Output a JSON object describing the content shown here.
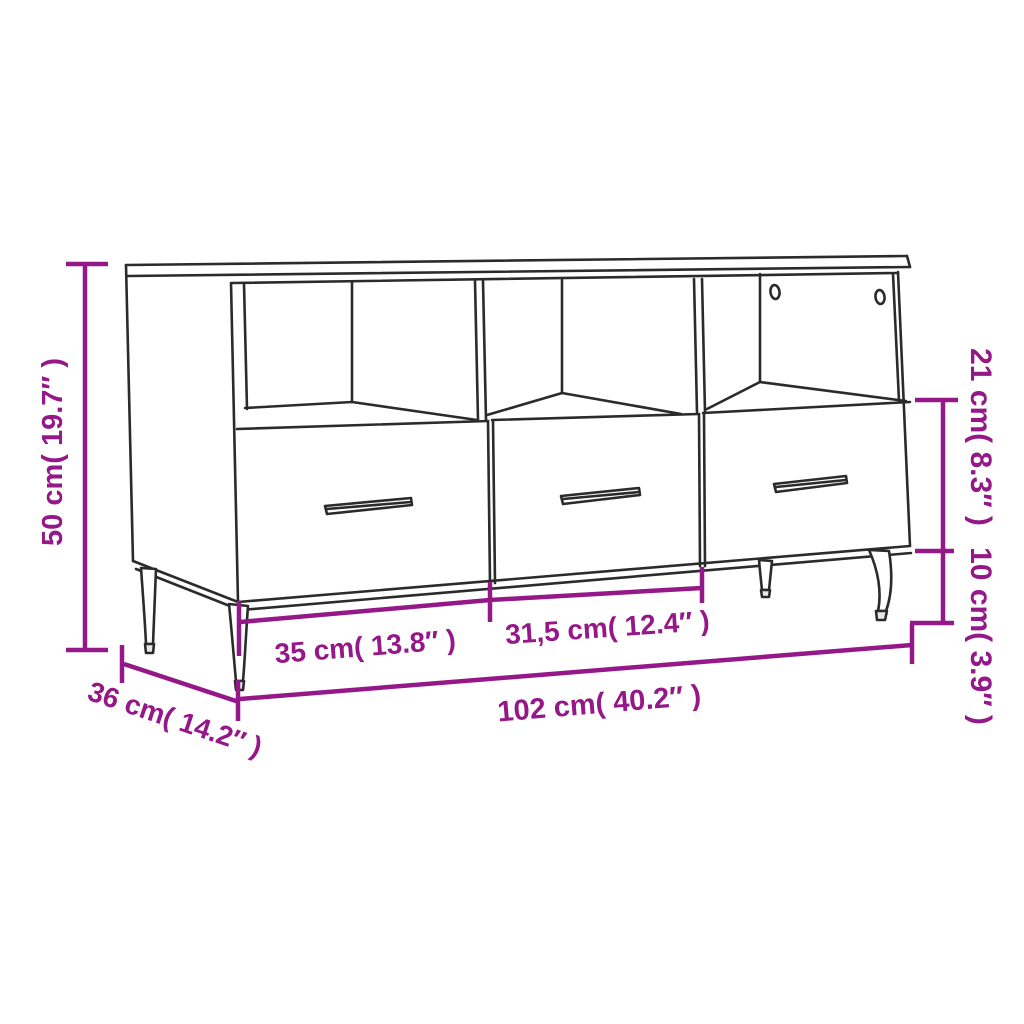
{
  "dimensions": {
    "height": "50 cm( 19.7″ )",
    "depth": "36 cm( 14.2″ )",
    "width": "102 cm( 40.2″ )",
    "left_drawer_width": "35 cm( 13.8″ )",
    "middle_drawer_width": "31,5 cm( 12.4″ )",
    "top_section_height": "21 cm( 8.3″ )",
    "leg_height": "10 cm( 3.9″ )"
  },
  "colors": {
    "dimension": "#951889",
    "outline": "#2b2b2b",
    "background": "#ffffff",
    "foot_fill": "#e9e9e9",
    "surface_fill": "#ffffff"
  }
}
